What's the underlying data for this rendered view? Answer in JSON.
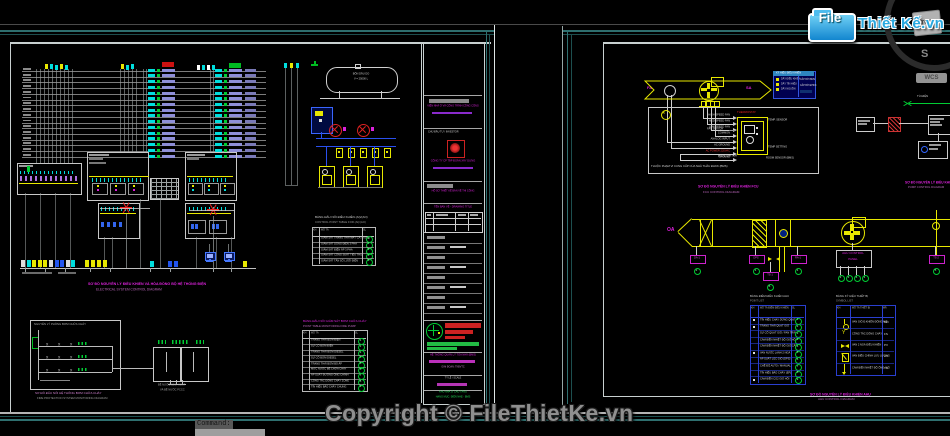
{
  "app": {
    "logo": {
      "file": "File",
      "brand": "Thiết Kế.vn"
    },
    "watermark": "Copyright © FileThietKe.vn",
    "viewcube": {
      "top": "TOP",
      "south": "S",
      "wcs": "WCS"
    },
    "command": {
      "prompt": "Command:"
    }
  },
  "colors": {
    "cad_yellow": "#e8e800",
    "cad_cyan": "#00dede",
    "cad_magenta": "#dd22dd",
    "cad_green": "#00cc33",
    "cad_red": "#dd2222",
    "cad_blue": "#2a50ee",
    "cad_lavender": "#8e8ed8",
    "sheet_teal": "#2e6f6f",
    "paper_line": "#c8d0d0",
    "logo_blue": "#29a8e0",
    "watermark_gray": "#8f8f8f"
  },
  "left_sheet": {
    "captions": {
      "electrical_vi": "SƠ ĐỒ NGUYÊN LÝ ĐIỀU KHIỂN VÀ HÒA ĐỒNG BỘ HỆ THỐNG ĐIỆN",
      "electrical_en": "ELECTRICAL SYSTEM CONTROL DIAGRAM",
      "fire_vi": "SƠ ĐỒ ĐẤU NỐI HỆ THỐNG BƠM CHỮA CHÁY",
      "fire_en": "FIRE PROTECTION SYSTEM MONITORING DIAGRAM",
      "tanks_1": "BỂ NƯỚC SINH HOẠT",
      "tanks_2": "VÀ BỂ NƯỚC PCCC"
    },
    "fuel": {
      "tank_1": "BỒN DẦU DO",
      "tank_2": "V = 25000 L"
    },
    "fire_box_title": "NGUYÊN LÝ PHÒNG BƠM CHỮA CHÁY",
    "table1": {
      "title_vi": "BẢNG ĐẤU NỐI ĐIỀU KHIỂN (AI)/(AO)",
      "title_en": "CONTROL POINT TABLE FOR (AI)/(AO)",
      "headers": [
        "KH",
        "MÔ TẢ",
        "SL"
      ],
      "rows": [
        {
          "desc": "GIÁM SÁT TRẠNG THÁI MÁY CẮT TỔNG",
          "num": "1"
        },
        {
          "desc": "GIÁM SÁT DÒNG ĐIỆN 3 PHA",
          "num": "2"
        },
        {
          "desc": "GIÁM SÁT ĐIỆN ÁP 3 PHA",
          "num": "3"
        },
        {
          "desc": "GIÁM SÁT CÔNG SUẤT TIÊU THỤ",
          "num": "4"
        },
        {
          "desc": "GIÁM SÁT TẦN SỐ LƯỚI ĐIỆN",
          "num": "5"
        }
      ]
    },
    "table2": {
      "title_vi": "BẢNG ĐẤU NỐI GIÁM SÁT BƠM CHỮA CHÁY",
      "title_en": "POINT TABLE MONITORING FIRE PUMP",
      "headers": [
        "KH",
        "MÔ TẢ",
        "SL"
      ],
      "rows": [
        {
          "desc": "TRẠNG THÁI BƠM ĐIỆN",
          "num": "1"
        },
        {
          "desc": "SỰ CỐ BƠM ĐIỆN",
          "num": "2"
        },
        {
          "desc": "TRẠNG THÁI BƠM DIESEL",
          "num": "3"
        },
        {
          "desc": "SỰ CỐ BƠM DIESEL",
          "num": "4"
        },
        {
          "desc": "TRẠNG THÁI BƠM BÙ ÁP",
          "num": "5"
        },
        {
          "desc": "MỨC NƯỚC BỂ CHỮA CHÁY",
          "num": "6"
        },
        {
          "desc": "ÁP SUẤT ĐƯỜNG ỐNG CHÍNH",
          "num": "7"
        },
        {
          "desc": "CÔNG TẮC DÒNG CHẢY ZONE",
          "num": "8"
        },
        {
          "desc": "TÍN HIỆU BÁO CHÁY CHUNG",
          "num": "9"
        }
      ]
    },
    "titleblock": {
      "org": "VIỆN NHÀ Ở VÀ CÔNG TRÌNH CÔNG CỘNG",
      "investor_label": "CHỦ ĐẦU TƯ / INVESTOR",
      "company": "CÔNG TY CP TẬP ĐOÀN XÂY DỰNG",
      "approve_1": "HỒ SƠ THIẾT KẾ BẢN VẼ THI CÔNG",
      "drawing_label": "TÊN BẢN VẼ - DRAWING TITLE",
      "approve_2": "HỆ THỐNG QUẢN LÝ TÒA NHÀ (BMS)",
      "note_1": "GIAI ĐOẠN: TKBVTC",
      "note_2": "TỶ LỆ / SCALE",
      "green_1": "KHU NHÀ Ở CAO TẦNG",
      "green_2": "HẠNG MỤC: ĐIỆN NHẸ - BMS"
    }
  },
  "right_sheet": {
    "fcu": {
      "fa": "FA",
      "sa": "SA",
      "thermostat": "THERMOSTAT",
      "fan_switch": "FAN SWITCH",
      "mode_switch": "MODE SWITCH",
      "temp_setting": "TEMP SETTING",
      "temp_sensor": "TEMP. SENSOR",
      "room_sensor": "ROOM SENSOR (BMS)",
      "scope": "THUỘC PHẠM VI CUNG CẤP CỦA NHÀ THẦU ĐHKK (BMS)",
      "wires": [
        "HIGH SPEED FAN",
        "MED SPEED FAN",
        "LOW SPEED FAN",
        "COMMON",
        "ANALOG INPUT",
        "AC GROUND",
        "AC POWER 220VAC",
        "GROUND"
      ],
      "caption_vi": "SƠ ĐỒ NGUYÊN LÝ ĐIỀU KHIỂN FCU",
      "caption_en": "FCU CONTROL DIAGRAM"
    },
    "legend": {
      "title": "KÝ HIỆU ĐIỀU KHIỂN",
      "rows": [
        "DÂY ĐIỀU KHIỂN",
        "DÂY TÍN HIỆU",
        "DÂY NGUỒN"
      ],
      "right_1": "CẤP BỞI BMS",
      "right_2": "CẤP BỞI ĐHKK"
    },
    "pump": {
      "label": "TỦ ĐIỆN",
      "caption_vi": "SƠ ĐỒ NGUYÊN LÝ ĐIỀU KHIỂN BƠM",
      "caption_en": "PUMP CONTROL DIAGRAM"
    },
    "ahu": {
      "oa": "OA",
      "panel_1": "AHU CONTROL",
      "panel_2": "PANEL",
      "caption_vi": "SƠ ĐỒ NGUYÊN LÝ ĐIỀU KHIỂN AHU",
      "caption_en": "AHU CONTROL DIAGRAM",
      "sensors": [
        {
          "label": "DA-1",
          "num": "2"
        },
        {
          "label": "DPS",
          "num": "1"
        },
        {
          "label": "TS-1",
          "num": "6"
        },
        {
          "label": "RA-1",
          "num": "1"
        },
        {
          "label": "TS-2",
          "num": "5"
        }
      ],
      "panel_nums": [
        "2",
        "3",
        "4",
        "1"
      ]
    },
    "point_table": {
      "title_vi": "BẢNG ĐIỂM ĐIỀU KHIỂN AHU",
      "title_en": "POINT LIST",
      "headers": [
        "KH",
        "MÔ TẢ ĐIỂM ĐIỀU KHIỂN",
        "SL"
      ],
      "rows": [
        {
          "desc": "TÍN HIỆU CHẠY DỪNG QUẠT",
          "num": "1",
          "dot": true
        },
        {
          "desc": "TRẠNG THÁI QUẠT GIÓ",
          "num": "2",
          "dot": true
        },
        {
          "desc": "SỰ CỐ QUẠT GIÓ / FAN TRIP",
          "num": "3",
          "dot": false
        },
        {
          "desc": "CẢM BIẾN NHIỆT ĐỘ GIÓ HỒI",
          "num": "3",
          "dot": false
        },
        {
          "desc": "CẢM BIẾN NHIỆT ĐỘ GIÓ CẤP",
          "num": "4",
          "dot": false
        },
        {
          "desc": "VAN NƯỚC LẠNH 2 NGẢ",
          "num": "5",
          "dot": true
        },
        {
          "desc": "ÁP SUẤT LỌC GIÓ (DPS)",
          "num": "6",
          "dot": false
        },
        {
          "desc": "CHẾ ĐỘ AUTO / MANUAL",
          "num": "7",
          "dot": false
        },
        {
          "desc": "TÍN HIỆU BÁO CHÁY (EP)",
          "num": "8",
          "dot": false
        },
        {
          "desc": "CẢM BIẾN CO2 GIÓ HỒI",
          "num": "9",
          "dot": true
        }
      ]
    },
    "symbol_table": {
      "title_vi": "BẢNG KÝ HIỆU THIẾT BỊ",
      "title_en": "SYMBOL LIST",
      "headers": [
        "KH",
        "MÔ TẢ THIẾT BỊ",
        "MÃ"
      ],
      "rows": [
        {
          "desc": "VAN GIÓ Đ.KHIỂN ĐÓNG MỞ",
          "code": "MD"
        },
        {
          "desc": "CÔNG TẮC DÒNG CHẢY",
          "code": "FS"
        },
        {
          "desc": "VAN 2 NGẢ ĐIỀU KHIỂN",
          "code": "PV"
        },
        {
          "desc": "VAN ĐIỀU CHỈNH LƯU LƯỢNG",
          "code": "CV"
        },
        {
          "desc": "CẢM BIẾN NHIỆT ĐỘ ỐNG GIÓ",
          "code": "TS"
        }
      ]
    }
  }
}
